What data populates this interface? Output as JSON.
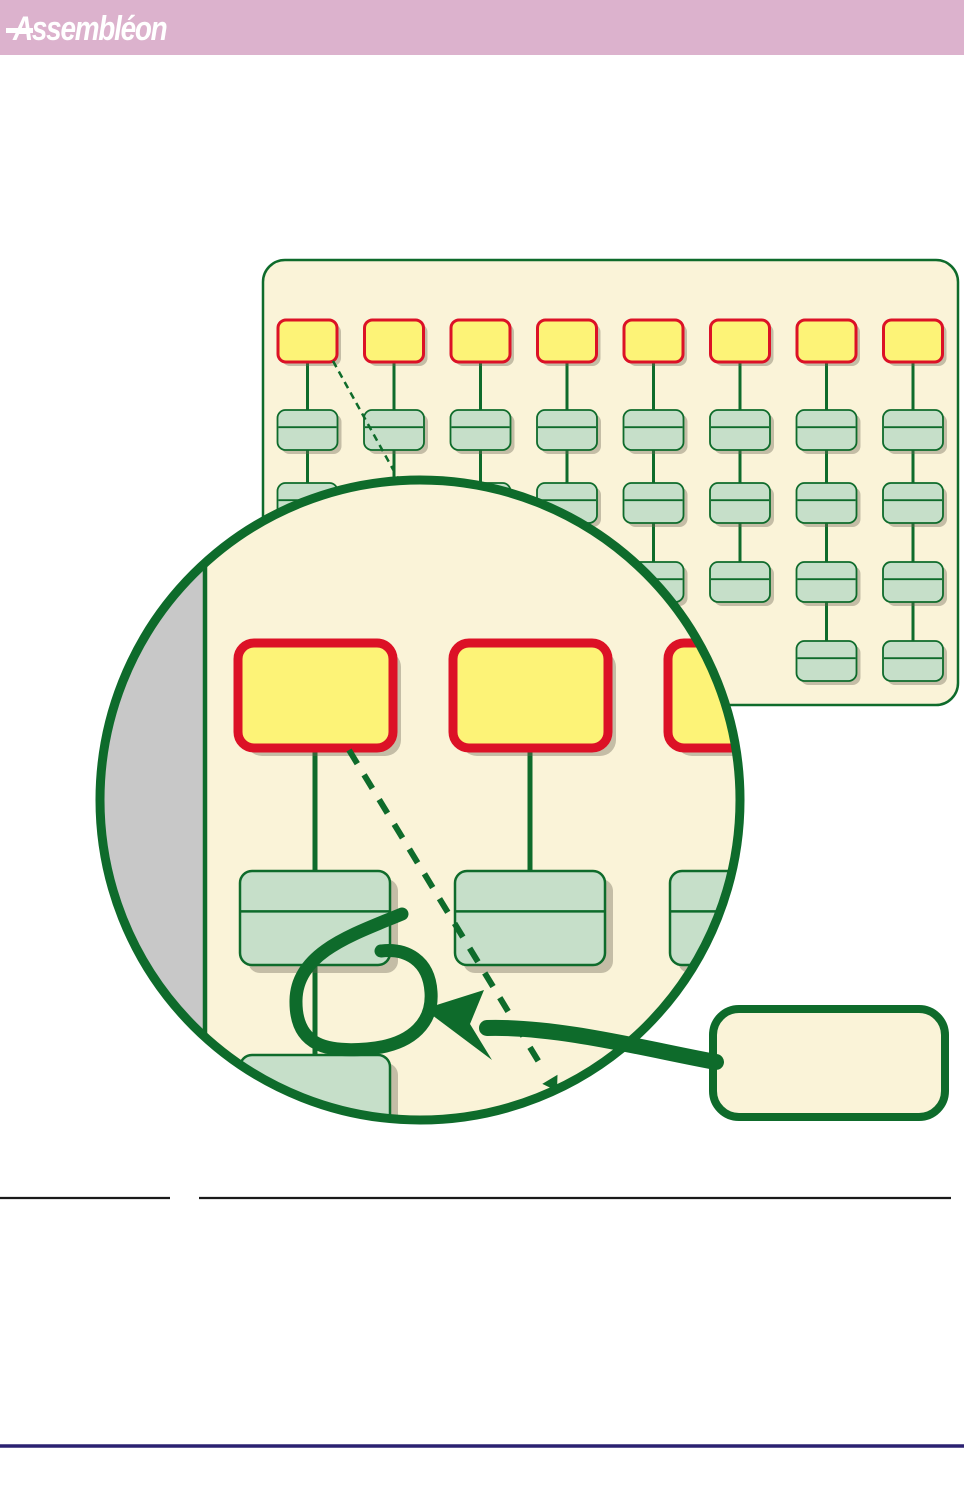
{
  "header": {
    "logo_text": "Assembléon",
    "bar_color": "#dcb2cd",
    "text_color": "#ffffff"
  },
  "page": {
    "width": 964,
    "height": 1502,
    "background": "#ffffff"
  },
  "colors": {
    "cream": "#faf3d8",
    "yellow": "#fdf377",
    "red": "#dc1126",
    "green_line": "#0e6b2b",
    "green_fill": "#c6dfc9",
    "grey": "#c8c8c8",
    "shadow": "rgba(108,103,84,0.38)",
    "black_line": "#1a1a1a",
    "navy_line": "#2b2171"
  },
  "diagram": {
    "panel": {
      "x": 263,
      "y": 260,
      "width": 695,
      "height": 445,
      "corner_radius": 22,
      "border_width": 2.5,
      "first_column_cx": 307.5,
      "column_spacing": 86.5,
      "green_box_counts": [
        2,
        2,
        2,
        3,
        3,
        3,
        4,
        4
      ],
      "yellow_box": {
        "y": 320,
        "width": 59,
        "height": 42,
        "corner_radius": 8,
        "border_width": 3
      },
      "green_rows_y": [
        410,
        483,
        562,
        641
      ],
      "green_box": {
        "width": 60,
        "height": 40,
        "corner_radius": 8,
        "border_width": 1.8,
        "divider_frac": 0.43
      },
      "connector_width": 3,
      "thin_dashed_line": {
        "x1": 333,
        "y1": 361,
        "x2": 410,
        "y2": 500,
        "width": 2.5,
        "dash": "7 5"
      }
    },
    "magnifier": {
      "cx": 420,
      "cy": 800,
      "radius": 320,
      "border_width": 9,
      "grey_strip_right_x": 205,
      "chord_line_width": 4.5,
      "yellow_boxes_x": [
        238,
        453,
        668
      ],
      "yellow_box": {
        "y": 643,
        "width": 155,
        "height": 105,
        "corner_radius": 16,
        "border_width": 9
      },
      "green_boxes_x": [
        240,
        455,
        670
      ],
      "green_box": {
        "y": 871,
        "width": 150,
        "height": 94,
        "corner_radius": 12,
        "border_width": 2.5,
        "divider_frac": 0.43
      },
      "bottom_green_box": {
        "x": 240,
        "y": 1055,
        "width": 150,
        "height": 80,
        "corner_radius": 12,
        "border_width": 2.5
      },
      "connector_xs": [
        315,
        530,
        745
      ],
      "connector_width": 5,
      "lower_connector": {
        "x": 315,
        "y1": 965,
        "y2": 1055
      },
      "shadow_offset": 8,
      "thick_dashed_line": {
        "x1": 349,
        "y1": 750,
        "x2": 545,
        "y2": 1072,
        "width": 6,
        "dash": "16 13"
      },
      "dashed_arrowhead_points": "557,1091 542.3,1083.9 557.5,1074.7"
    },
    "callout": {
      "x": 713,
      "y": 1009,
      "width": 232,
      "height": 108,
      "corner_radius": 26,
      "border_width": 8,
      "label": ""
    },
    "annotation_arrow": {
      "shaft_path": "M 716,1062 C 650,1050 560,1026 487,1028",
      "shaft_width": 16,
      "head_points": "424,1009 484,990 470,1024 492,1060",
      "loop_path": "M 402,914 C 354,934 297,952 296,1000 C 295,1048 330,1052 367,1049 C 415,1045 433,1020 431,992 C 429,960 406,948 381,951",
      "loop_width": 13
    }
  },
  "separators": {
    "short_black_line": {
      "x1": 0,
      "x2": 170,
      "y": 1198,
      "width": 2.2
    },
    "long_black_line": {
      "x1": 199,
      "x2": 951,
      "y": 1198,
      "width": 2.2
    },
    "footer_blue_line": {
      "x1": 0,
      "x2": 964,
      "y": 1446,
      "width": 3.6
    }
  }
}
